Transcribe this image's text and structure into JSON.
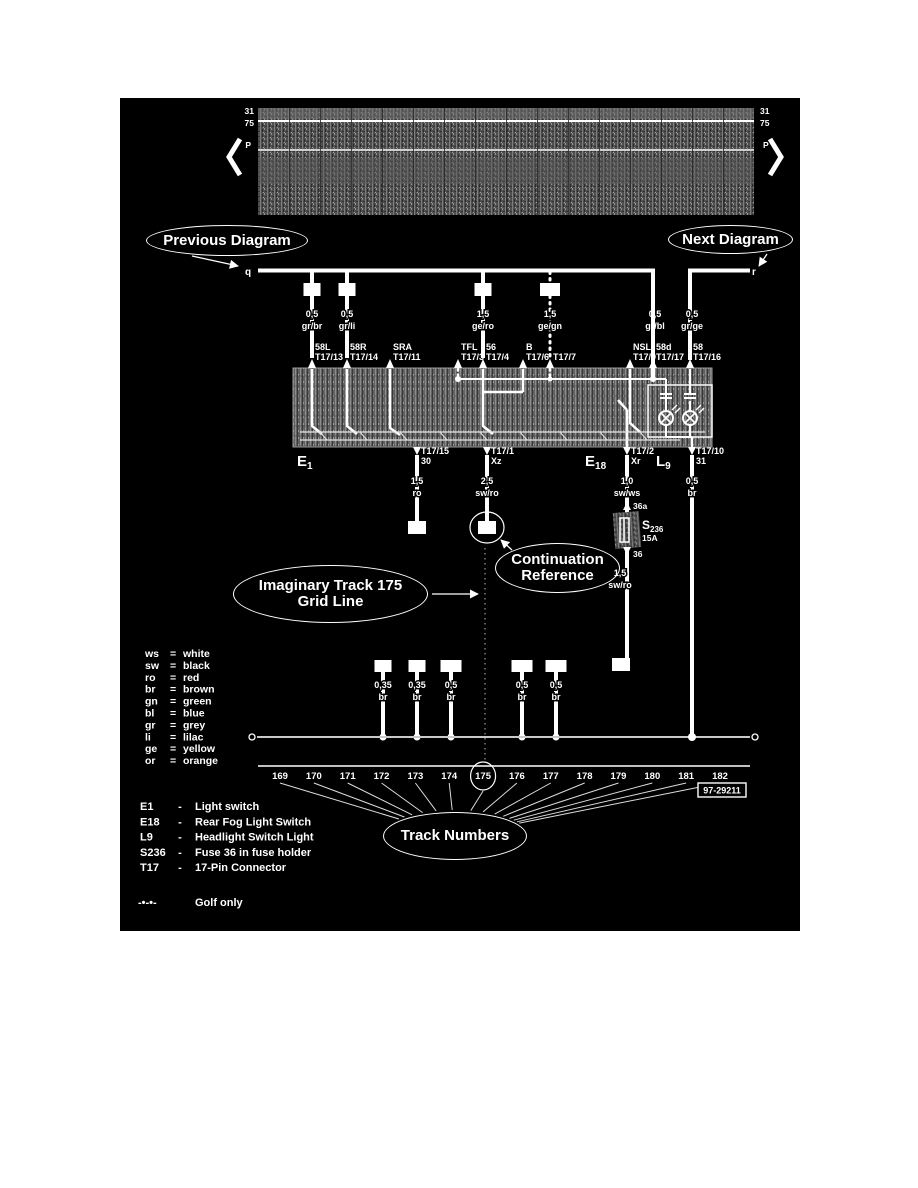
{
  "colors": {
    "page_bg": "#ffffff",
    "diagram_bg": "#000000",
    "line": "#ffffff",
    "texture": "#5a5a5a"
  },
  "top_band": {
    "left_labels": [
      "31",
      "75",
      "P"
    ],
    "right_labels": [
      "31",
      "75",
      "P"
    ]
  },
  "callouts": {
    "previous": "Previous Diagram",
    "next": "Next Diagram",
    "continuation": [
      "Continuation",
      "Reference"
    ],
    "imaginary": [
      "Imaginary Track 175",
      "Grid Line"
    ],
    "tracks": "Track Numbers"
  },
  "bus": {
    "left_end": "q",
    "right_end": "r"
  },
  "top_circuits": [
    {
      "ref": "57",
      "x": 192,
      "gauge": "0,5",
      "color": "gr/br",
      "dotted": false
    },
    {
      "ref": "66",
      "x": 227,
      "gauge": "0,5",
      "color": "gr/li",
      "dotted": false
    },
    {
      "ref": "86",
      "x": 363,
      "gauge": "1,5",
      "color": "ge/ro",
      "dotted": false
    },
    {
      "ref": "106",
      "x": 430,
      "gauge": "1,5",
      "color": "ge/gn",
      "dotted": true
    }
  ],
  "feed_circuits": [
    {
      "x": 533,
      "gauge": "0,5",
      "color": "gr/bl"
    },
    {
      "x": 570,
      "gauge": "0,5",
      "color": "gr/ge"
    }
  ],
  "terminals_top": [
    {
      "name": "58L",
      "pin": "T17/13",
      "x": 192
    },
    {
      "name": "58R",
      "pin": "T17/14",
      "x": 227
    },
    {
      "name": "SRA",
      "pin": "T17/11",
      "x": 270
    },
    {
      "name": "TFL",
      "pin": "T17/3",
      "x": 338
    },
    {
      "name": "56",
      "pin": "T17/4",
      "x": 363
    },
    {
      "name": "B",
      "pin": "T17/6",
      "x": 403
    },
    {
      "name": "",
      "pin": "T17/7",
      "x": 430
    },
    {
      "name": "NSL",
      "pin": "T17/9",
      "x": 510
    },
    {
      "name": "58d",
      "pin": "T17/17",
      "x": 533
    },
    {
      "name": "58",
      "pin": "T17/16",
      "x": 570
    }
  ],
  "components": [
    {
      "code": "E",
      "sub": "1",
      "x": 177
    },
    {
      "code": "E",
      "sub": "18",
      "x": 465
    },
    {
      "code": "L",
      "sub": "9",
      "x": 536
    }
  ],
  "terminals_bottom": [
    {
      "pin": "T17/15",
      "term": "30",
      "x": 297
    },
    {
      "pin": "T17/1",
      "term": "Xz",
      "x": 367
    },
    {
      "pin": "T17/2",
      "term": "Xr",
      "x": 507
    },
    {
      "pin": "T17/10",
      "term": "31",
      "x": 572
    }
  ],
  "drop_wires": [
    {
      "x": 297,
      "gauge": "1,5",
      "color": "ro",
      "ref": "10",
      "circled": false
    },
    {
      "x": 367,
      "gauge": "2,5",
      "color": "sw/ro",
      "ref": "8",
      "circled": true
    },
    {
      "x": 507,
      "gauge": "1,0",
      "color": "sw/ws",
      "ref": "",
      "circled": false
    },
    {
      "x": 572,
      "gauge": "0,5",
      "color": "br",
      "ref": "",
      "circled": false
    }
  ],
  "fuse_s236": {
    "code": "S",
    "sub": "236",
    "amps": "15A",
    "pin_top": "36a",
    "pin_bottom": "36",
    "wire_below_gauge": "1,5",
    "wire_below_color": "sw/ro",
    "ref": "9"
  },
  "ground_wires": [
    {
      "id": "71",
      "x": 263,
      "gauge": "0,35",
      "color": "br"
    },
    {
      "id": "72",
      "x": 297,
      "gauge": "0,35",
      "color": "br"
    },
    {
      "id": "109",
      "x": 331,
      "gauge": "0,5",
      "color": "br"
    },
    {
      "id": "253",
      "x": 402,
      "gauge": "0,5",
      "color": "br"
    },
    {
      "id": "254",
      "x": 436,
      "gauge": "0,5",
      "color": "br"
    }
  ],
  "tracks": {
    "numbers": [
      "169",
      "170",
      "171",
      "172",
      "173",
      "174",
      "175",
      "176",
      "177",
      "178",
      "179",
      "180",
      "181",
      "182"
    ],
    "highlighted": "175",
    "doc_number": "97-29211"
  },
  "color_legend": [
    {
      "code": "ws",
      "name": "white"
    },
    {
      "code": "sw",
      "name": "black"
    },
    {
      "code": "ro",
      "name": "red"
    },
    {
      "code": "br",
      "name": "brown"
    },
    {
      "code": "gn",
      "name": "green"
    },
    {
      "code": "bl",
      "name": "blue"
    },
    {
      "code": "gr",
      "name": "grey"
    },
    {
      "code": "li",
      "name": "lilac"
    },
    {
      "code": "ge",
      "name": "yellow"
    },
    {
      "code": "or",
      "name": "orange"
    }
  ],
  "component_legend": [
    {
      "code": "E1",
      "name": "Light switch"
    },
    {
      "code": "E18",
      "name": "Rear Fog Light Switch"
    },
    {
      "code": "L9",
      "name": "Headlight Switch Light"
    },
    {
      "code": "S236",
      "name": "Fuse 36 in fuse holder"
    },
    {
      "code": "T17",
      "name": "17-Pin Connector"
    }
  ],
  "golf_note": {
    "symbol": "-•-•-",
    "text": "Golf only"
  }
}
